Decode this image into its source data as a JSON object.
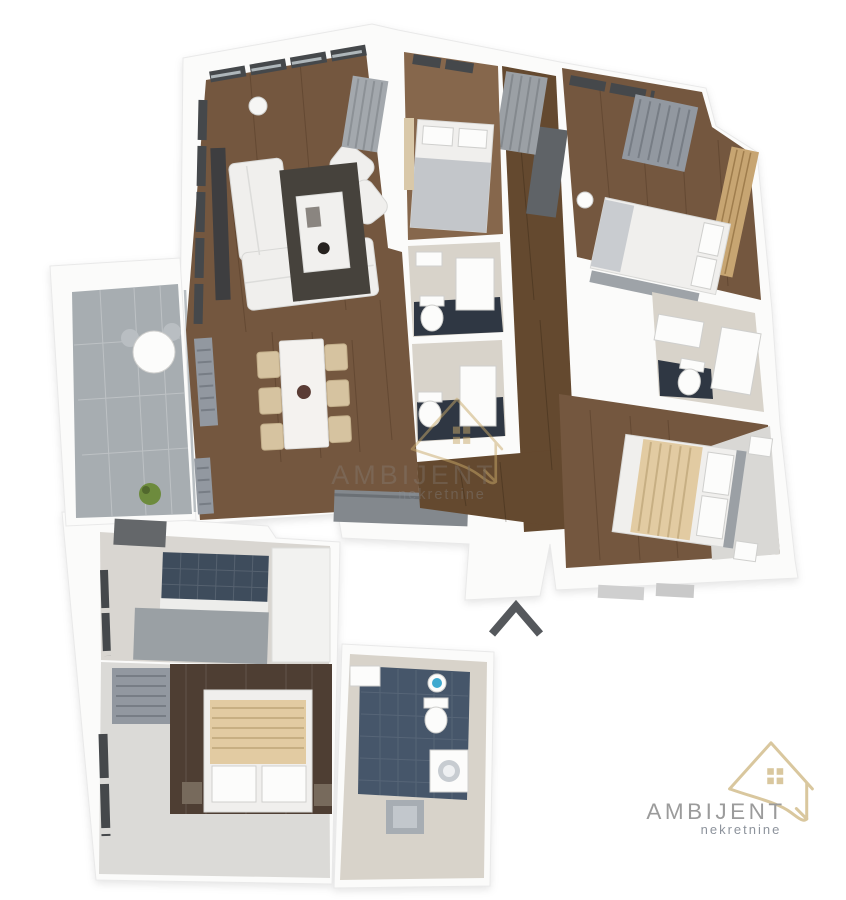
{
  "brand": {
    "name": "AMBIJENT",
    "tagline": "nekretnine"
  },
  "watermark": {
    "name": "AMBIJENT",
    "tagline": "nekretnine"
  },
  "colors": {
    "background": "#FFFFFF",
    "wall": "#FBFBFA",
    "wall_edge": "#E9E9E9",
    "wood_floor": "#74573F",
    "wood_floor_light": "#86674C",
    "wood_floor_dark": "#64492F",
    "accent_wood_wall": "#4E3E33",
    "headboard_wood": "#C7A572",
    "rug_dark": "#46423C",
    "tile_dark": "#2F3743",
    "tile_blue": "#46566A",
    "tile_beige": "#D8D3CA",
    "balcony_tile": "#A7ADB1",
    "kitchen_tile_blue": "#3E4C5C",
    "counter_gray": "#9AA0A4",
    "furniture_white": "#F0EFED",
    "blanket_beige": "#E2CBA2",
    "blanket_gray": "#C3C6CA",
    "radiator_gray": "#9298A0",
    "wardrobe_gray": "#5F6367",
    "sideboard_gray": "#83888D",
    "plant_green": "#6D8B3D",
    "arrow_gray": "#55585C",
    "logo_gold": "#D9C79E",
    "logo_text_gray": "#9B9B9B",
    "logo_tagline_gray": "#8D939C",
    "watermark_gold": "#C8A96A",
    "watermark_text_gray": "#8C8C8C"
  },
  "icons": {
    "house_logo": "house-outline-with-window",
    "entrance_arrow": "chevron-up"
  },
  "floorplan": {
    "type": "3d-apartment-floor-plan",
    "rooms": [
      {
        "id": "living-room",
        "floor": "dark-wood",
        "furniture": [
          "corner-sofa",
          "two-armchairs",
          "rug",
          "coffee-table",
          "tv-panel",
          "floor-lamp",
          "curtain",
          "windows"
        ]
      },
      {
        "id": "dining-area",
        "floor": "dark-wood",
        "furniture": [
          "marble-dining-table",
          "six-chairs",
          "two-radiators"
        ]
      },
      {
        "id": "bedroom-top-middle",
        "floor": "wood",
        "furniture": [
          "single-bed",
          "curtain",
          "window",
          "gray-wardrobe"
        ]
      },
      {
        "id": "bathroom-1",
        "floor": "dark-tile",
        "furniture": [
          "toilet",
          "shower",
          "sink"
        ]
      },
      {
        "id": "bathroom-2",
        "floor": "dark-tile",
        "furniture": [
          "toilet",
          "shower"
        ]
      },
      {
        "id": "bedroom-top-right",
        "floor": "wood",
        "furniture": [
          "double-bed",
          "slat-headboard-wall",
          "radiator",
          "windows",
          "bench"
        ]
      },
      {
        "id": "bathroom-right",
        "floor": "beige-tile",
        "furniture": [
          "toilet",
          "vanity",
          "shower"
        ]
      },
      {
        "id": "bedroom-right",
        "floor": "wood",
        "furniture": [
          "double-bed-beige-blanket",
          "two-nightstands",
          "headboard"
        ]
      },
      {
        "id": "kitchen",
        "floor": "light-tile",
        "furniture": [
          "blue-tile-backsplash",
          "counter",
          "tall-cabinet",
          "window"
        ]
      },
      {
        "id": "bedroom-bottom-left",
        "floor": "light-tile",
        "furniture": [
          "double-bed-beige-blanket",
          "dark-accent-wall",
          "radiator",
          "window",
          "two-nightstands"
        ]
      },
      {
        "id": "bathroom-bottom",
        "floor": "blue-tile",
        "furniture": [
          "shower-head",
          "toilet",
          "washing-machine",
          "sink",
          "bath-mat"
        ]
      },
      {
        "id": "balcony",
        "floor": "gray-tile",
        "furniture": [
          "round-table",
          "two-chairs",
          "plant"
        ]
      },
      {
        "id": "hallway",
        "floor": "dark-wood",
        "furniture": [
          "wardrobe",
          "sideboard"
        ]
      }
    ],
    "entrance_marker": "chevron pointing up at bottom center"
  }
}
